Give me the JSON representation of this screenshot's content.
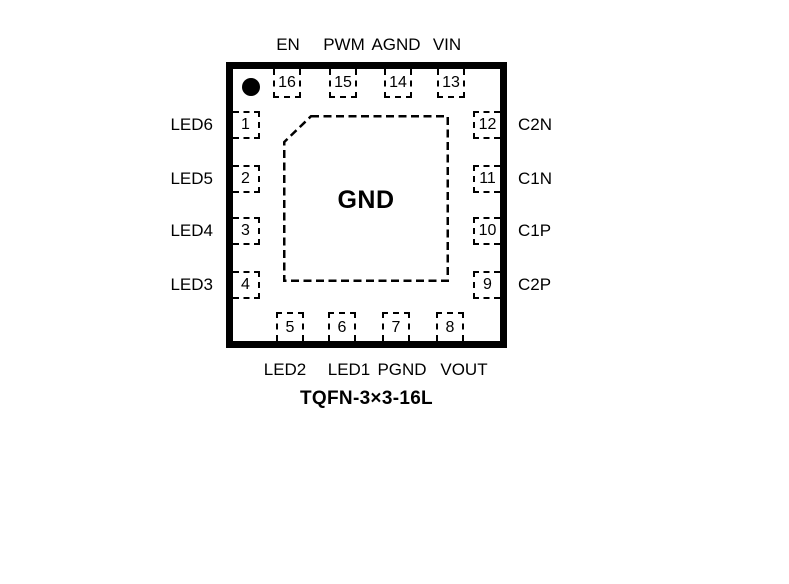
{
  "diagram": {
    "type": "ic-pinout",
    "package_name": "TQFN-3×3-16L",
    "center_pad_label": "GND",
    "pin1_indicator": "filled-circle"
  },
  "pins": {
    "top": [
      {
        "num": "16",
        "label": "EN"
      },
      {
        "num": "15",
        "label": "PWM"
      },
      {
        "num": "14",
        "label": "AGND"
      },
      {
        "num": "13",
        "label": "VIN"
      }
    ],
    "left": [
      {
        "num": "1",
        "label": "LED6"
      },
      {
        "num": "2",
        "label": "LED5"
      },
      {
        "num": "3",
        "label": "LED4"
      },
      {
        "num": "4",
        "label": "LED3"
      }
    ],
    "right": [
      {
        "num": "12",
        "label": "C2N"
      },
      {
        "num": "11",
        "label": "C1N"
      },
      {
        "num": "10",
        "label": "C1P"
      },
      {
        "num": "9",
        "label": "C2P"
      }
    ],
    "bottom": [
      {
        "num": "5",
        "label": "LED2"
      },
      {
        "num": "6",
        "label": "LED1"
      },
      {
        "num": "7",
        "label": "PGND"
      },
      {
        "num": "8",
        "label": "VOUT"
      }
    ]
  },
  "colors": {
    "line": "#000000",
    "text": "#000000",
    "background": "#ffffff"
  }
}
